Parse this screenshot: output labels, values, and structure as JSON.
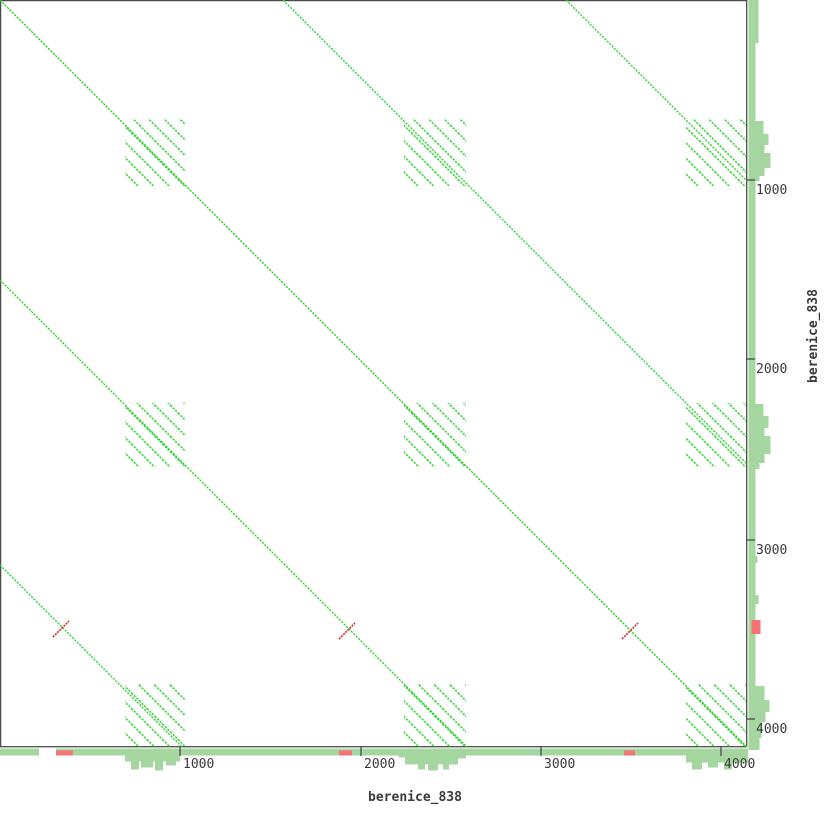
{
  "sequence_name": "berenice_838",
  "colors": {
    "forward_green": "#2ed02e",
    "reverse_red": "#d22f2f",
    "histogram_green": "#a5d6a0",
    "histogram_red": "#f57373",
    "border_gray": "#4b4b4b",
    "text_gray": "#3a3a3a",
    "background": "#ffffff"
  },
  "chart_data": {
    "type": "scatter",
    "subtype": "dotplot-self-comparison",
    "title": "",
    "xlabel": "berenice_838",
    "ylabel": "berenice_838",
    "x_range_units": [
      0,
      4140
    ],
    "y_range_units": [
      0,
      4140
    ],
    "units_per_px": 5.55,
    "plot_size_px": [
      747,
      747
    ],
    "grid": false,
    "x_ticks": [
      {
        "value": "1000",
        "px": 180
      },
      {
        "value": "2000",
        "px": 361
      },
      {
        "value": "3000",
        "px": 541
      },
      {
        "value": "4000",
        "px": 721
      }
    ],
    "y_ticks": [
      {
        "value": "1000",
        "px": 180
      },
      {
        "value": "2000",
        "px": 359
      },
      {
        "value": "3000",
        "px": 540
      },
      {
        "value": "4000",
        "px": 719
      }
    ],
    "forward_diagonals": {
      "main": true,
      "upper_x_intercepts_px": [
        283,
        566
      ],
      "lower_y_intercepts_px": [
        280,
        565
      ],
      "repeat_period_units": 1570
    },
    "repeat_blocks": {
      "col_spans_px": [
        [
          125,
          185
        ],
        [
          404,
          466
        ],
        [
          686,
          746
        ]
      ],
      "row_spans_px": [
        [
          119,
          186
        ],
        [
          403,
          467
        ],
        [
          684,
          747
        ]
      ],
      "col_spans_units": [
        [
          693,
          1026
        ],
        [
          2241,
          2585
        ],
        [
          3805,
          4138
        ]
      ],
      "hatch_spacing_px": 11
    },
    "reverse_matches": {
      "centers_px": [
        [
          61,
          629
        ],
        [
          347,
          631
        ],
        [
          630,
          631
        ]
      ],
      "centers_units": [
        [
          338,
          3489
        ],
        [
          1925,
          3500
        ],
        [
          3494,
          3500
        ]
      ],
      "arm_px": 8
    },
    "histogram_right": {
      "anchor_x_px": 748.5,
      "base": {
        "y": 0,
        "h": 746,
        "w": 7
      },
      "bars": [
        {
          "y": 0,
          "h": 43,
          "w": 10
        },
        {
          "y": 121,
          "h": 13,
          "w": 15
        },
        {
          "y": 134,
          "h": 11,
          "w": 20
        },
        {
          "y": 145,
          "h": 8,
          "w": 16
        },
        {
          "y": 153,
          "h": 15,
          "w": 22
        },
        {
          "y": 168,
          "h": 8,
          "w": 16
        },
        {
          "y": 176,
          "h": 5,
          "w": 11
        },
        {
          "y": 404,
          "h": 12,
          "w": 15
        },
        {
          "y": 416,
          "h": 12,
          "w": 20
        },
        {
          "y": 428,
          "h": 8,
          "w": 16
        },
        {
          "y": 436,
          "h": 18,
          "w": 22
        },
        {
          "y": 454,
          "h": 9,
          "w": 16
        },
        {
          "y": 463,
          "h": 6,
          "w": 11
        },
        {
          "y": 556,
          "h": 7,
          "w": 9
        },
        {
          "y": 595,
          "h": 9,
          "w": 10
        },
        {
          "y": 686,
          "h": 14,
          "w": 16
        },
        {
          "y": 700,
          "h": 12,
          "w": 21
        },
        {
          "y": 712,
          "h": 10,
          "w": 17
        },
        {
          "y": 722,
          "h": 16,
          "w": 13
        },
        {
          "y": 738,
          "h": 12,
          "w": 11
        }
      ],
      "red_segments": [
        {
          "y": 620,
          "h": 14,
          "x_off": 3,
          "w": 9
        }
      ]
    },
    "histogram_bottom": {
      "anchor_y_px": 748.5,
      "base": {
        "x": 0,
        "w": 746,
        "h": 7
      },
      "gaps": [
        {
          "x": 39,
          "w": 17
        }
      ],
      "bars": [
        {
          "x": 125,
          "w": 55,
          "h": 13
        },
        {
          "x": 131,
          "w": 8,
          "h": 21
        },
        {
          "x": 141,
          "w": 12,
          "h": 19
        },
        {
          "x": 155,
          "w": 8,
          "h": 22
        },
        {
          "x": 166,
          "w": 10,
          "h": 17
        },
        {
          "x": 399,
          "w": 6,
          "h": 9
        },
        {
          "x": 405,
          "w": 53,
          "h": 16
        },
        {
          "x": 418,
          "w": 7,
          "h": 21
        },
        {
          "x": 428,
          "w": 10,
          "h": 22
        },
        {
          "x": 443,
          "w": 6,
          "h": 21
        },
        {
          "x": 458,
          "w": 8,
          "h": 10
        },
        {
          "x": 686,
          "w": 62,
          "h": 14
        },
        {
          "x": 692,
          "w": 10,
          "h": 21
        },
        {
          "x": 708,
          "w": 10,
          "h": 19
        },
        {
          "x": 724,
          "w": 8,
          "h": 21
        }
      ],
      "red_segments": [
        {
          "x": 56,
          "w": 17,
          "y_off": 2,
          "h": 5
        },
        {
          "x": 339,
          "w": 13,
          "y_off": 2,
          "h": 5
        },
        {
          "x": 624,
          "w": 11,
          "y_off": 2,
          "h": 5
        }
      ]
    }
  }
}
